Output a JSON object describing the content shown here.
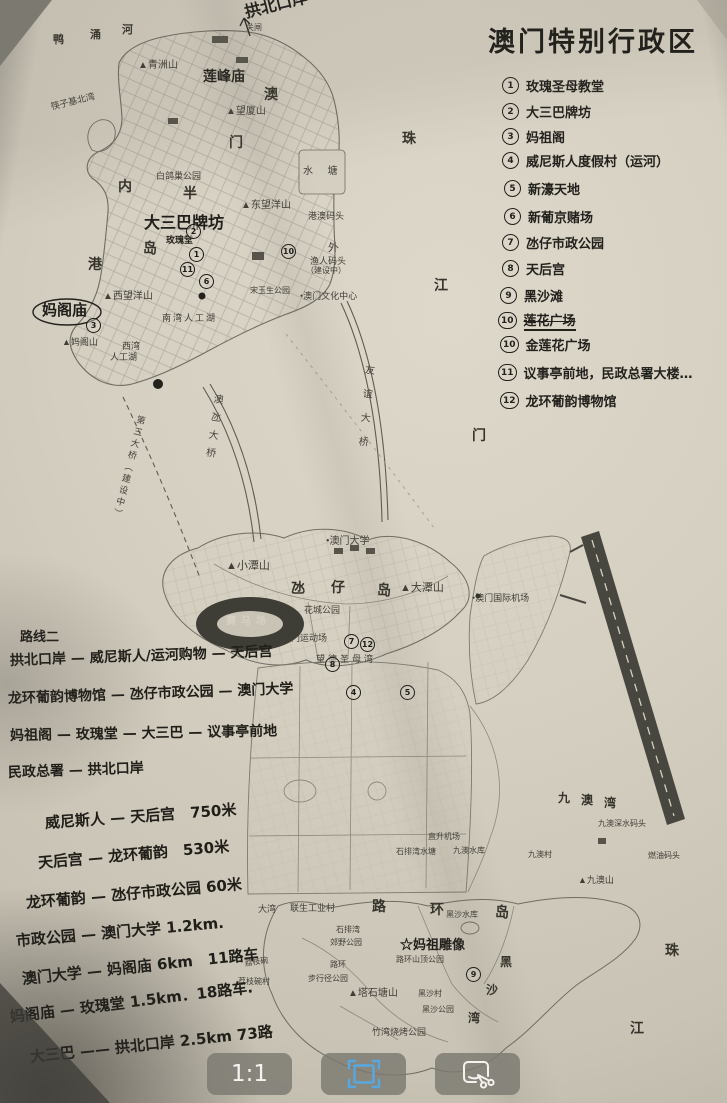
{
  "title": "澳门特别行政区",
  "legend": {
    "items": [
      {
        "num": "1",
        "label": "玫瑰圣母教堂",
        "x": 502,
        "y": 76
      },
      {
        "num": "2",
        "label": "大三巴牌坊",
        "x": 502,
        "y": 102
      },
      {
        "num": "3",
        "label": "妈祖阁",
        "x": 502,
        "y": 127
      },
      {
        "num": "4",
        "label": "威尼斯人度假村（运河）",
        "x": 502,
        "y": 151
      },
      {
        "num": "5",
        "label": "新濠天地",
        "x": 504,
        "y": 179
      },
      {
        "num": "6",
        "label": "新葡京赌场",
        "x": 504,
        "y": 207
      },
      {
        "num": "7",
        "label": "氹仔市政公园",
        "x": 502,
        "y": 233
      },
      {
        "num": "8",
        "label": "天后宫",
        "x": 502,
        "y": 259
      },
      {
        "num": "9",
        "label": "黑沙滩",
        "x": 500,
        "y": 286
      },
      {
        "num": "10",
        "label": "莲花广场",
        "struck": true,
        "x": 498,
        "y": 310
      },
      {
        "num": "10",
        "label": "金莲花广场",
        "x": 500,
        "y": 335
      },
      {
        "num": "11",
        "label": "议事亭前地，民政总署大楼…",
        "x": 498,
        "y": 363
      },
      {
        "num": "12",
        "label": "龙环葡韵博物馆",
        "x": 500,
        "y": 391
      }
    ]
  },
  "route_notes": {
    "heading": "路线二",
    "lines": [
      {
        "t": "拱北口岸 — 威尼斯人/运河购物 — 天后宫",
        "x": 10,
        "y": 650,
        "rot": -2
      },
      {
        "t": "龙环葡韵博物馆 — 氹仔市政公园 — 澳门大学",
        "x": 8,
        "y": 688,
        "rot": -2
      },
      {
        "t": "妈祖阁 — 玫瑰堂 — 大三巴 — 议事亭前地",
        "x": 10,
        "y": 725,
        "rot": -1
      },
      {
        "t": "民政总署 — 拱北口岸",
        "x": 8,
        "y": 762,
        "rot": -2
      }
    ]
  },
  "distance_notes": [
    {
      "t": "威尼斯人 — 天后宫　750米",
      "x": 45,
      "y": 812,
      "rot": -4
    },
    {
      "t": "天后宫 — 龙环葡韵　530米",
      "x": 38,
      "y": 852,
      "rot": -5
    },
    {
      "t": "龙环葡韵 — 氹仔市政公园 60米",
      "x": 26,
      "y": 892,
      "rot": -5
    },
    {
      "t": "市政公园 — 澳门大学 1.2km.",
      "x": 16,
      "y": 930,
      "rot": -5
    },
    {
      "t": "澳门大学 — 妈阁庙 6km　11路车",
      "x": 22,
      "y": 968,
      "rot": -6
    },
    {
      "t": "妈阁庙 — 玫瑰堂 1.5km．18路车.",
      "x": 10,
      "y": 1006,
      "rot": -7
    },
    {
      "t": "大三巴 —— 拱北口岸 2.5km 73路",
      "x": 30,
      "y": 1046,
      "rot": -6
    }
  ],
  "map": {
    "labels": [
      {
        "t": "拱北口岸",
        "x": 243,
        "y": 4,
        "cls": "hand",
        "s": 16,
        "rot": -14
      },
      {
        "t": "关闸",
        "x": 246,
        "y": 24,
        "s": 8
      },
      {
        "t": "鸭",
        "x": 53,
        "y": 34,
        "cls": "big",
        "s": 11
      },
      {
        "t": "涌",
        "x": 90,
        "y": 29,
        "cls": "big",
        "s": 11
      },
      {
        "t": "河",
        "x": 122,
        "y": 24,
        "cls": "big",
        "s": 11
      },
      {
        "t": "▲青洲山",
        "x": 138,
        "y": 60,
        "s": 10
      },
      {
        "t": "筷子基北湾",
        "x": 50,
        "y": 103,
        "s": 9,
        "rot": -14
      },
      {
        "t": "莲峰庙",
        "x": 203,
        "y": 70,
        "cls": "pb",
        "s": 14
      },
      {
        "t": "▲望厦山",
        "x": 226,
        "y": 106,
        "s": 10
      },
      {
        "t": "澳",
        "x": 264,
        "y": 88,
        "cls": "big"
      },
      {
        "t": "门",
        "x": 229,
        "y": 136,
        "cls": "big"
      },
      {
        "t": "水 塘",
        "x": 303,
        "y": 166,
        "s": 10,
        "ls": 6
      },
      {
        "t": "白鸽巢公园",
        "x": 156,
        "y": 172,
        "s": 9
      },
      {
        "t": "内",
        "x": 118,
        "y": 180,
        "cls": "big"
      },
      {
        "t": "港",
        "x": 88,
        "y": 258,
        "cls": "big"
      },
      {
        "t": "半",
        "x": 183,
        "y": 187,
        "cls": "big"
      },
      {
        "t": "岛",
        "x": 143,
        "y": 242,
        "cls": "big"
      },
      {
        "t": "大三巴牌坊",
        "x": 144,
        "y": 215,
        "cls": "pb",
        "s": 16
      },
      {
        "t": "玫瑰堂",
        "x": 166,
        "y": 236,
        "cls": "pb",
        "s": 9
      },
      {
        "t": "▲东望洋山",
        "x": 241,
        "y": 200,
        "s": 10
      },
      {
        "t": "港澳码头",
        "x": 308,
        "y": 212,
        "s": 9
      },
      {
        "t": "外",
        "x": 328,
        "y": 242,
        "s": 11
      },
      {
        "t": "渔人码头",
        "x": 310,
        "y": 257,
        "s": 9
      },
      {
        "t": "（建设中）",
        "x": 306,
        "y": 267,
        "s": 8
      },
      {
        "t": "宋玉生公园",
        "x": 250,
        "y": 287,
        "s": 8
      },
      {
        "t": "•澳门文化中心",
        "x": 300,
        "y": 292,
        "s": 9
      },
      {
        "t": "▲西望洋山",
        "x": 103,
        "y": 291,
        "s": 10
      },
      {
        "t": "妈阁庙",
        "x": 42,
        "y": 302,
        "cls": "hand",
        "s": 15
      },
      {
        "t": "▲妈阁山",
        "x": 62,
        "y": 338,
        "s": 9
      },
      {
        "t": "南湾人工湖",
        "x": 162,
        "y": 314,
        "s": 9,
        "ls": 2
      },
      {
        "t": "西湾",
        "x": 122,
        "y": 342,
        "s": 9
      },
      {
        "t": "人工湖",
        "x": 110,
        "y": 353,
        "s": 9
      },
      {
        "t": "珠",
        "x": 402,
        "y": 132,
        "cls": "big"
      },
      {
        "t": "江",
        "x": 434,
        "y": 279,
        "cls": "big"
      },
      {
        "t": "门",
        "x": 472,
        "y": 429,
        "cls": "big"
      },
      {
        "t": "澳氹大桥",
        "x": 212,
        "y": 393,
        "cls": "v",
        "s": 10,
        "ls": 8,
        "rot": 8
      },
      {
        "t": "友谊大桥",
        "x": 363,
        "y": 364,
        "cls": "v",
        "s": 10,
        "ls": 14,
        "rot": 5
      },
      {
        "t": "第三大桥（建设中）",
        "x": 136,
        "y": 414,
        "cls": "v",
        "s": 9,
        "ls": 3,
        "rot": 14
      },
      {
        "t": "•澳门大学",
        "x": 326,
        "y": 536,
        "s": 10
      },
      {
        "t": "▲小潭山",
        "x": 226,
        "y": 560,
        "s": 11
      },
      {
        "t": "氹",
        "x": 291,
        "y": 582,
        "cls": "big"
      },
      {
        "t": "仔",
        "x": 331,
        "y": 581,
        "cls": "big"
      },
      {
        "t": "岛",
        "x": 377,
        "y": 584,
        "cls": "big"
      },
      {
        "t": "▲大潭山",
        "x": 400,
        "y": 582,
        "s": 11
      },
      {
        "t": "花城公园",
        "x": 304,
        "y": 606,
        "s": 9
      },
      {
        "t": "赛马场",
        "x": 226,
        "y": 616,
        "cls": "light",
        "s": 10,
        "ls": 5
      },
      {
        "t": "澳门运动场",
        "x": 282,
        "y": 634,
        "s": 9
      },
      {
        "t": "望德圣母湾",
        "x": 316,
        "y": 655,
        "s": 9,
        "ls": 3
      },
      {
        "t": "•澳门国际机场",
        "x": 472,
        "y": 594,
        "s": 9
      },
      {
        "t": "九",
        "x": 558,
        "y": 792,
        "cls": "big",
        "s": 12
      },
      {
        "t": "澳",
        "x": 581,
        "y": 794,
        "cls": "big",
        "s": 12
      },
      {
        "t": "湾",
        "x": 604,
        "y": 797,
        "cls": "big",
        "s": 12
      },
      {
        "t": "九澳深水码头",
        "x": 598,
        "y": 820,
        "s": 8
      },
      {
        "t": "燃油码头",
        "x": 648,
        "y": 852,
        "s": 8
      },
      {
        "t": "▲九澳山",
        "x": 578,
        "y": 876,
        "s": 9
      },
      {
        "t": "直升机场",
        "x": 428,
        "y": 833,
        "s": 8
      },
      {
        "t": "九澳水库",
        "x": 453,
        "y": 847,
        "s": 8
      },
      {
        "t": "九澳村",
        "x": 528,
        "y": 851,
        "s": 8
      },
      {
        "t": "石排湾水塘",
        "x": 396,
        "y": 848,
        "s": 8
      },
      {
        "t": "大湾",
        "x": 258,
        "y": 905,
        "s": 9
      },
      {
        "t": "联生工业村",
        "x": 290,
        "y": 904,
        "s": 9
      },
      {
        "t": "路",
        "x": 372,
        "y": 900,
        "cls": "big"
      },
      {
        "t": "环",
        "x": 430,
        "y": 903,
        "cls": "big"
      },
      {
        "t": "岛",
        "x": 495,
        "y": 906,
        "cls": "big"
      },
      {
        "t": "黑沙水库",
        "x": 446,
        "y": 911,
        "s": 8
      },
      {
        "t": "石排湾",
        "x": 336,
        "y": 926,
        "s": 8
      },
      {
        "t": "郊野公园",
        "x": 330,
        "y": 939,
        "s": 8
      },
      {
        "t": "☆妈祖雕像",
        "x": 400,
        "y": 938,
        "cls": "pb",
        "s": 13
      },
      {
        "t": "路环山顶公园",
        "x": 396,
        "y": 956,
        "s": 8
      },
      {
        "t": "路环",
        "x": 330,
        "y": 961,
        "s": 8
      },
      {
        "t": "步行径公园",
        "x": 308,
        "y": 975,
        "s": 8
      },
      {
        "t": "荔枝碗",
        "x": 244,
        "y": 960,
        "s": 8,
        "rot": -8
      },
      {
        "t": "荔枝碗村",
        "x": 238,
        "y": 978,
        "s": 8
      },
      {
        "t": "▲塔石塘山",
        "x": 348,
        "y": 988,
        "s": 10
      },
      {
        "t": "黑沙村",
        "x": 418,
        "y": 990,
        "s": 8
      },
      {
        "t": "黑沙公园",
        "x": 422,
        "y": 1006,
        "s": 8
      },
      {
        "t": "竹湾烧烤公园",
        "x": 372,
        "y": 1028,
        "s": 9
      },
      {
        "t": "黑",
        "x": 500,
        "y": 956,
        "cls": "big",
        "s": 12
      },
      {
        "t": "沙",
        "x": 486,
        "y": 984,
        "cls": "big",
        "s": 12
      },
      {
        "t": "湾",
        "x": 468,
        "y": 1012,
        "cls": "big",
        "s": 12
      },
      {
        "t": "珠",
        "x": 665,
        "y": 944,
        "cls": "big"
      },
      {
        "t": "江",
        "x": 630,
        "y": 1022,
        "cls": "big"
      }
    ],
    "markers": [
      {
        "num": "2",
        "x": 186,
        "y": 224
      },
      {
        "num": "1",
        "x": 189,
        "y": 247
      },
      {
        "num": "11",
        "x": 180,
        "y": 262
      },
      {
        "num": "6",
        "x": 199,
        "y": 274
      },
      {
        "num": "10",
        "x": 281,
        "y": 244
      },
      {
        "num": "3",
        "x": 86,
        "y": 318
      },
      {
        "num": "7",
        "x": 344,
        "y": 634
      },
      {
        "num": "12",
        "x": 360,
        "y": 637
      },
      {
        "num": "8",
        "x": 325,
        "y": 657
      },
      {
        "num": "4",
        "x": 346,
        "y": 685
      },
      {
        "num": "5",
        "x": 400,
        "y": 685
      },
      {
        "num": "9",
        "x": 466,
        "y": 967
      }
    ]
  },
  "viewer": {
    "toolbar": {
      "zoom_label": "1:1",
      "crop_icon": "crop-frame-icon",
      "cut_icon": "screenshot-cut-icon",
      "accent_color": "#56a8e0"
    }
  }
}
